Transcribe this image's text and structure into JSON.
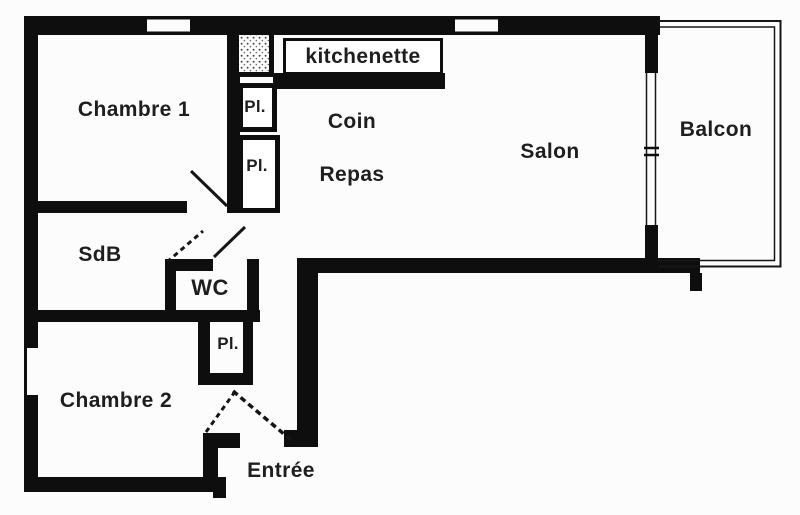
{
  "rooms": {
    "chambre1": {
      "label": "Chambre 1"
    },
    "kitchenette": {
      "label": "kitchenette"
    },
    "coin_repas": {
      "line1": "Coin",
      "line2": "Repas"
    },
    "salon": {
      "label": "Salon"
    },
    "balcon": {
      "label": "Balcon"
    },
    "sdb": {
      "label": "SdB"
    },
    "wc": {
      "label": "WC"
    },
    "chambre2": {
      "label": "Chambre 2"
    },
    "entree": {
      "label": "Entrée"
    },
    "closet_top1": {
      "label": "Pl."
    },
    "closet_top2": {
      "label": "Pl."
    },
    "closet_hall": {
      "label": "Pl."
    }
  },
  "colors": {
    "wall": "#0e0e0e",
    "background": "#fcfcfc",
    "text": "#1e1e1e"
  }
}
